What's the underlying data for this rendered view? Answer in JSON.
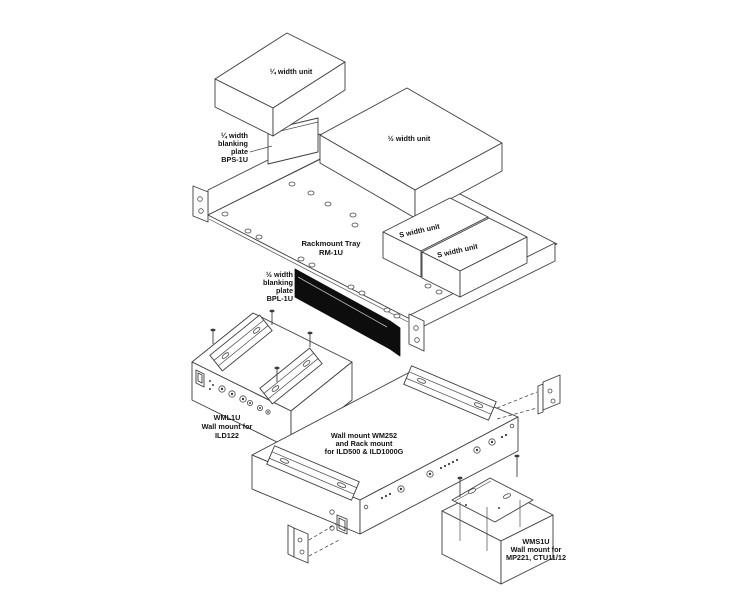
{
  "diagram": {
    "type": "exploded-assembly-diagram",
    "colors": {
      "background": "#ffffff",
      "line": "#3d3d3d",
      "text": "#141414",
      "blanking_plate_fill": "#0d0d0d"
    },
    "labels": {
      "quarter_unit": "¼ width unit",
      "half_unit": "½ width unit",
      "s_unit_a": "S width unit",
      "s_unit_b": "S width unit",
      "tray": [
        "Rackmount Tray",
        "RM-1U"
      ],
      "bps": [
        "¼ width",
        "blanking",
        "plate",
        "BPS-1U"
      ],
      "bpl": [
        "½ width",
        "blanking",
        "plate",
        "BPL-1U"
      ],
      "wml": [
        "WML1U",
        "Wall mount for",
        "ILD122"
      ],
      "wm252": [
        "Wall mount WM252",
        "and Rack mount",
        "for ILD500 & ILD1000G"
      ],
      "wms": [
        "WMS1U",
        "Wall mount for",
        "MP221, CTU11/12"
      ]
    }
  }
}
